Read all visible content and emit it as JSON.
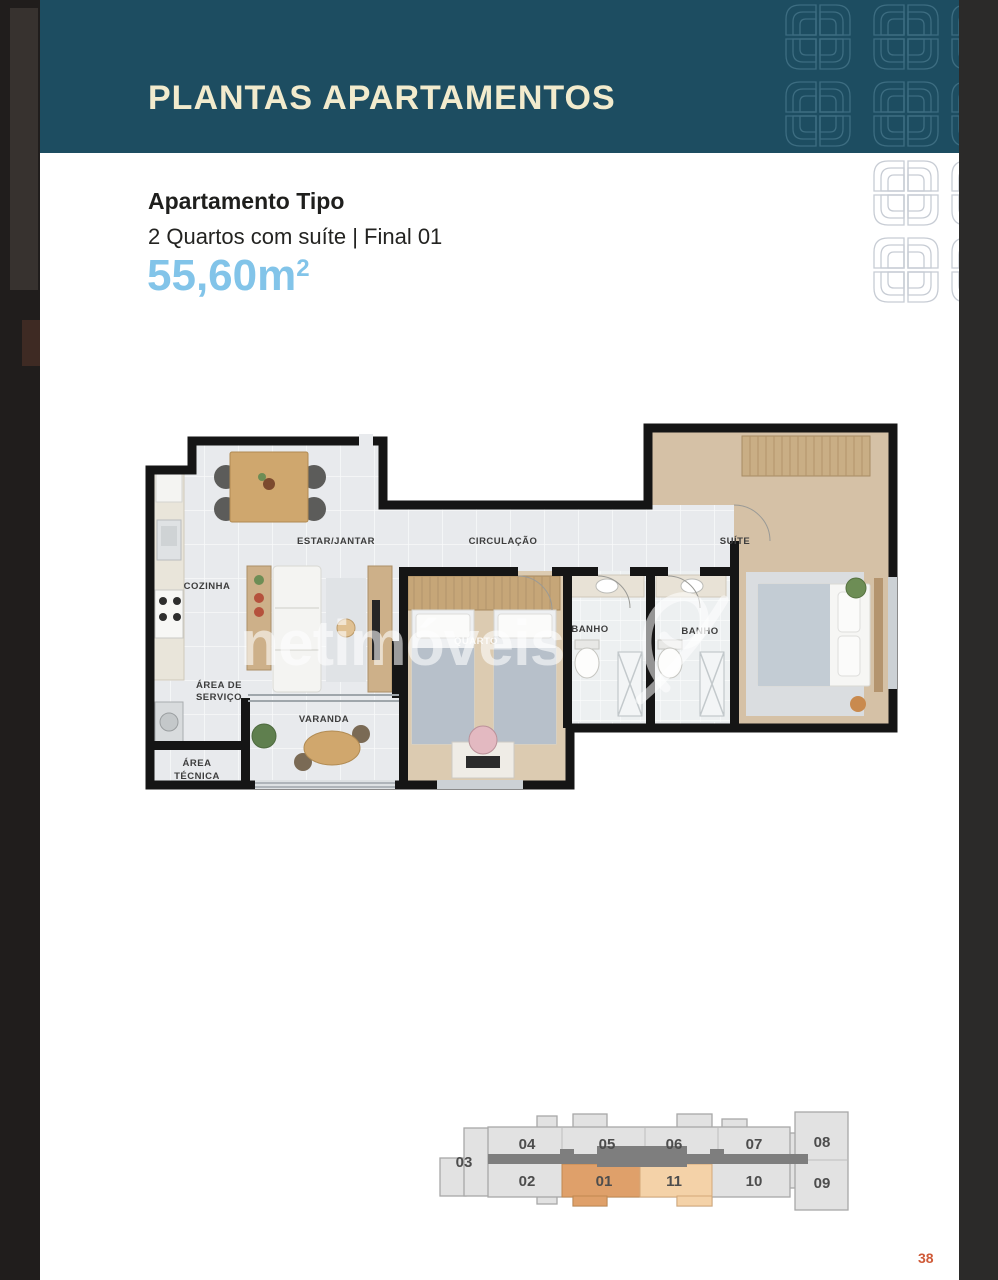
{
  "header": {
    "title": "PLANTAS APARTAMENTOS"
  },
  "apartment": {
    "type_label": "Apartamento Tipo",
    "description": "2 Quartos com suíte | Final 01",
    "area": "55,60m",
    "area_exponent": "2"
  },
  "floorplan": {
    "watermark": "netimóveis",
    "labels": {
      "cozinha": "COZINHA",
      "estar_jantar": "ESTAR/JANTAR",
      "circulacao": "CIRCULAÇÃO",
      "suite": "SUÍTE",
      "banho1": "BANHO",
      "banho2": "BANHO",
      "quarto": "QUARTO",
      "area_servico_line1": "ÁREA DE",
      "area_servico_line2": "SERVIÇO",
      "varanda": "VARANDA",
      "area_tecnica_line1": "ÁREA",
      "area_tecnica_line2": "TÉCNICA"
    }
  },
  "keyplan": {
    "units": [
      {
        "label": "03",
        "highlight": false
      },
      {
        "label": "04",
        "highlight": false
      },
      {
        "label": "05",
        "highlight": false
      },
      {
        "label": "06",
        "highlight": false
      },
      {
        "label": "07",
        "highlight": false
      },
      {
        "label": "08",
        "highlight": false
      },
      {
        "label": "02",
        "highlight": false
      },
      {
        "label": "01",
        "highlight": true,
        "tone": "strong"
      },
      {
        "label": "11",
        "highlight": true,
        "tone": "light"
      },
      {
        "label": "10",
        "highlight": false
      },
      {
        "label": "09",
        "highlight": false
      }
    ]
  },
  "page": {
    "number": "38"
  },
  "colors": {
    "band_teal": "#1d4d61",
    "title_cream": "#f2ebcd",
    "area_blue": "#82c4e9",
    "page_number_orange": "#cf5a38",
    "unit_01_highlight": "#dfa06a",
    "unit_11_highlight": "#f4d2a8",
    "keyplan_corridor": "#7e7e7e",
    "plan_wall": "#151515"
  }
}
